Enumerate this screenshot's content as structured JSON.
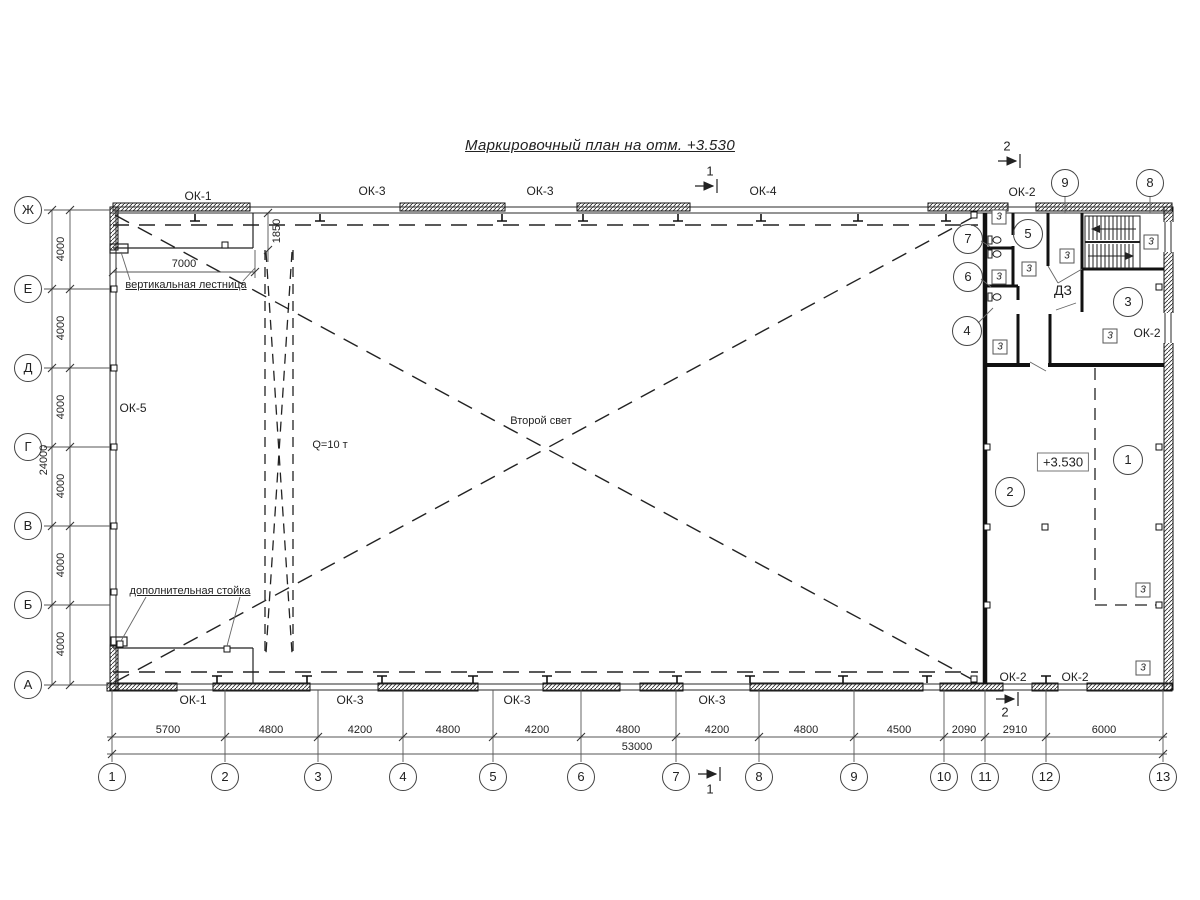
{
  "title": "Маркировочный план на отм. +3.530",
  "level_mark": {
    "t": "+3.530",
    "x": 1063,
    "y": 462
  },
  "window_labels": [
    {
      "t": "ОК-1",
      "x": 198,
      "y": 196
    },
    {
      "t": "ОК-3",
      "x": 372,
      "y": 191
    },
    {
      "t": "ОК-3",
      "x": 540,
      "y": 191
    },
    {
      "t": "ОК-4",
      "x": 763,
      "y": 191
    },
    {
      "t": "ОК-2",
      "x": 1022,
      "y": 192
    },
    {
      "t": "ОК-5",
      "x": 133,
      "y": 408
    },
    {
      "t": "ОК-2",
      "x": 1147,
      "y": 333
    },
    {
      "t": "ОК-1",
      "x": 193,
      "y": 700
    },
    {
      "t": "ОК-3",
      "x": 350,
      "y": 700
    },
    {
      "t": "ОК-3",
      "x": 517,
      "y": 700
    },
    {
      "t": "ОК-3",
      "x": 712,
      "y": 700
    },
    {
      "t": "ОК-2",
      "x": 1013,
      "y": 677
    },
    {
      "t": "ОК-2",
      "x": 1075,
      "y": 677
    }
  ],
  "annotations": [
    {
      "t": "вертикальная лестница",
      "x": 186,
      "y": 285,
      "s": 11,
      "u": true,
      "name": "note-vertical-ladder"
    },
    {
      "t": "дополнительная стойка",
      "x": 190,
      "y": 591,
      "s": 11,
      "u": true,
      "name": "note-additional-post"
    },
    {
      "t": "Q=10 т",
      "x": 330,
      "y": 445,
      "s": 11,
      "name": "crane-capacity"
    },
    {
      "t": "Второй свет",
      "x": 541,
      "y": 421,
      "s": 11,
      "name": "note-double-height"
    },
    {
      "t": "ДЗ",
      "x": 1063,
      "y": 290,
      "s": 14,
      "name": "shaft-label"
    }
  ],
  "door_marks": [
    {
      "t": "3",
      "x": 999,
      "y": 217
    },
    {
      "t": "3",
      "x": 1029,
      "y": 269
    },
    {
      "t": "3",
      "x": 999,
      "y": 277
    },
    {
      "t": "3",
      "x": 1000,
      "y": 347
    },
    {
      "t": "3",
      "x": 1067,
      "y": 256
    },
    {
      "t": "3",
      "x": 1151,
      "y": 242
    },
    {
      "t": "3",
      "x": 1110,
      "y": 336
    },
    {
      "t": "3",
      "x": 1143,
      "y": 590
    },
    {
      "t": "3",
      "x": 1143,
      "y": 668
    }
  ],
  "room_numbers": [
    {
      "t": "7",
      "x": 968,
      "y": 239
    },
    {
      "t": "6",
      "x": 968,
      "y": 277
    },
    {
      "t": "4",
      "x": 967,
      "y": 331
    },
    {
      "t": "5",
      "x": 1028,
      "y": 234
    },
    {
      "t": "3",
      "x": 1128,
      "y": 302
    },
    {
      "t": "2",
      "x": 1010,
      "y": 492
    },
    {
      "t": "1",
      "x": 1128,
      "y": 460
    }
  ],
  "grid_letters": [
    {
      "t": "Ж",
      "x": 28,
      "y": 210
    },
    {
      "t": "Е",
      "x": 28,
      "y": 289
    },
    {
      "t": "Д",
      "x": 28,
      "y": 368
    },
    {
      "t": "Г",
      "x": 28,
      "y": 447
    },
    {
      "t": "В",
      "x": 28,
      "y": 526
    },
    {
      "t": "Б",
      "x": 28,
      "y": 605
    },
    {
      "t": "А",
      "x": 28,
      "y": 685
    }
  ],
  "grid_numbers_bottom": [
    {
      "t": "1",
      "x": 112,
      "y": 777
    },
    {
      "t": "2",
      "x": 225,
      "y": 777
    },
    {
      "t": "3",
      "x": 318,
      "y": 777
    },
    {
      "t": "4",
      "x": 403,
      "y": 777
    },
    {
      "t": "5",
      "x": 493,
      "y": 777
    },
    {
      "t": "6",
      "x": 581,
      "y": 777
    },
    {
      "t": "7",
      "x": 676,
      "y": 777
    },
    {
      "t": "8",
      "x": 759,
      "y": 777
    },
    {
      "t": "9",
      "x": 854,
      "y": 777
    },
    {
      "t": "10",
      "x": 944,
      "y": 777
    },
    {
      "t": "11",
      "x": 985,
      "y": 777
    },
    {
      "t": "12",
      "x": 1046,
      "y": 777
    },
    {
      "t": "13",
      "x": 1163,
      "y": 777
    }
  ],
  "grid_numbers_top": [
    {
      "t": "9",
      "x": 1065,
      "y": 183
    },
    {
      "t": "8",
      "x": 1150,
      "y": 183
    }
  ],
  "dim_bottom": [
    {
      "t": "5700",
      "x": 168,
      "y": 730
    },
    {
      "t": "4800",
      "x": 271,
      "y": 730
    },
    {
      "t": "4200",
      "x": 360,
      "y": 730
    },
    {
      "t": "4800",
      "x": 448,
      "y": 730
    },
    {
      "t": "4200",
      "x": 537,
      "y": 730
    },
    {
      "t": "4800",
      "x": 628,
      "y": 730
    },
    {
      "t": "4200",
      "x": 717,
      "y": 730
    },
    {
      "t": "4800",
      "x": 806,
      "y": 730
    },
    {
      "t": "4500",
      "x": 899,
      "y": 730
    },
    {
      "t": "2090",
      "x": 964,
      "y": 730
    },
    {
      "t": "2910",
      "x": 1015,
      "y": 730
    },
    {
      "t": "6000",
      "x": 1104,
      "y": 730
    }
  ],
  "dim_left": [
    {
      "t": "4000",
      "x": 61,
      "y": 249,
      "r": true
    },
    {
      "t": "4000",
      "x": 61,
      "y": 328,
      "r": true
    },
    {
      "t": "4000",
      "x": 61,
      "y": 407,
      "r": true
    },
    {
      "t": "4000",
      "x": 61,
      "y": 486,
      "r": true
    },
    {
      "t": "4000",
      "x": 61,
      "y": 565,
      "r": true
    },
    {
      "t": "4000",
      "x": 61,
      "y": 644,
      "r": true
    }
  ],
  "dim_top": [
    {
      "t": "7000",
      "x": 184,
      "y": 264
    },
    {
      "t": "1850",
      "x": 277,
      "y": 231,
      "r": true
    }
  ],
  "dim_totals": [
    {
      "t": "53000",
      "x": 637,
      "y": 747
    },
    {
      "t": "24000",
      "x": 44,
      "y": 460,
      "r": true
    }
  ],
  "section_marks": [
    {
      "t": "1",
      "x": 710,
      "y": 171,
      "name": "section-1-top"
    },
    {
      "t": "2",
      "x": 1007,
      "y": 146,
      "name": "section-2-top"
    },
    {
      "t": "1",
      "x": 710,
      "y": 789,
      "name": "section-1-bottom"
    },
    {
      "t": "2",
      "x": 1005,
      "y": 712,
      "name": "section-2-bottom"
    }
  ]
}
